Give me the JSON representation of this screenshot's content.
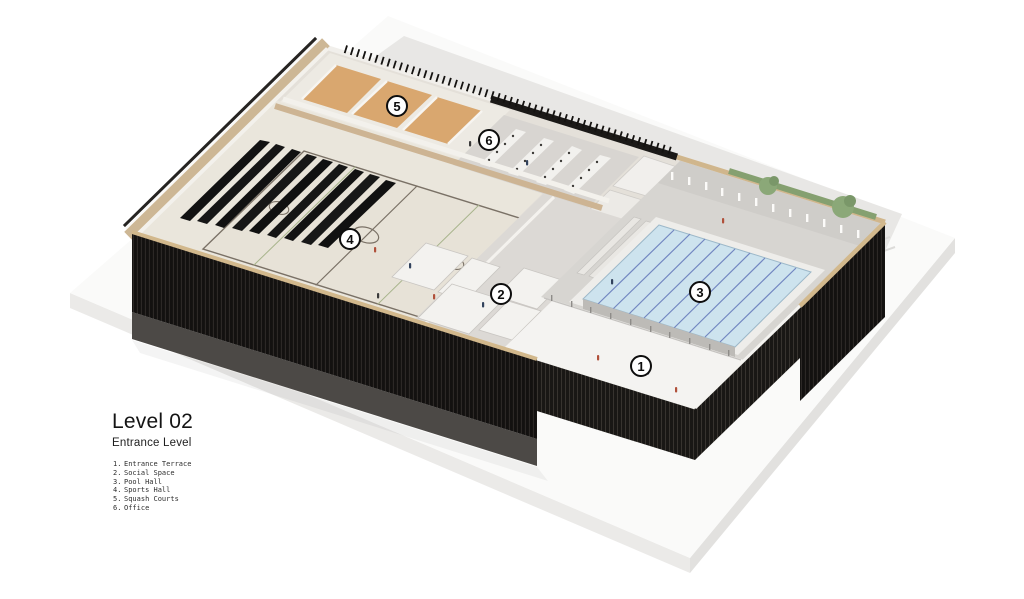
{
  "title_block": {
    "title": "Level 02",
    "subtitle": "Entrance Level"
  },
  "legend": {
    "items": [
      {
        "num": "1.",
        "label": "Entrance Terrace"
      },
      {
        "num": "2.",
        "label": "Social Space"
      },
      {
        "num": "3.",
        "label": "Pool Hall"
      },
      {
        "num": "4.",
        "label": "Sports Hall"
      },
      {
        "num": "5.",
        "label": "Squash Courts"
      },
      {
        "num": "6.",
        "label": "Office"
      }
    ]
  },
  "markers": [
    {
      "n": "1"
    },
    {
      "n": "2"
    },
    {
      "n": "3"
    },
    {
      "n": "4"
    },
    {
      "n": "5"
    },
    {
      "n": "6"
    }
  ],
  "colors": {
    "background": "#ffffff",
    "site_plane_gray": "#e8e7e5",
    "plinth_white": "#fafaf9",
    "facade_black": "#131110",
    "facade_lower_gray": "#4c4946",
    "wood_trim": "#cdb795",
    "squash_wood_floor": "#d9a76f",
    "sports_hall_floor": "#eae6dc",
    "court_line": "#7a7166",
    "court_line_green": "#a8b48c",
    "bleacher_black": "#121212",
    "social_floor": "#dcd9d5",
    "pool_deck": "#d7d5d1",
    "pool_water": "#cde3ee",
    "lane_line_blue": "#7287c1",
    "terrace_white": "#f4f3f1",
    "tree_green": "#8ba878",
    "marker_border": "#0d0d0d"
  }
}
